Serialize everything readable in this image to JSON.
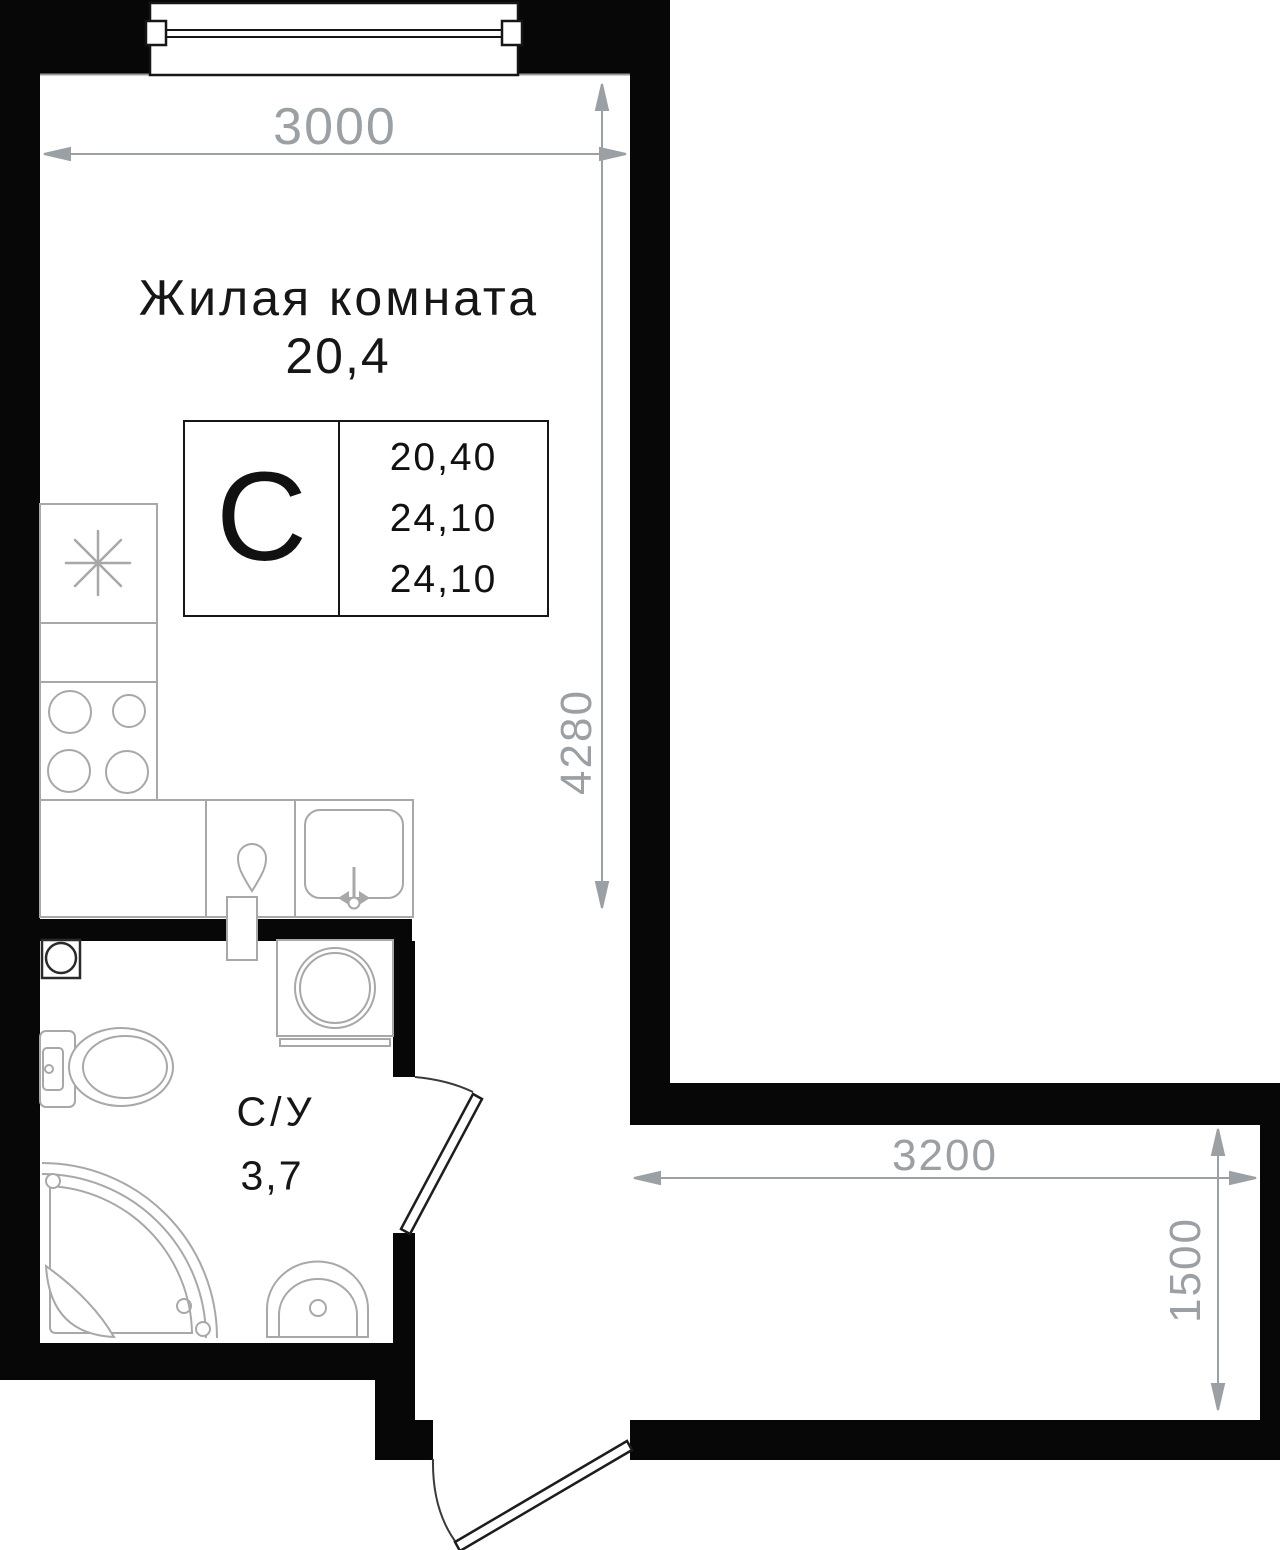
{
  "plan_title": "Studio apartment floor plan",
  "living_room": {
    "label": "Жилая комната",
    "area": "20,4"
  },
  "bathroom": {
    "label": "С/У",
    "area": "3,7"
  },
  "unit_card": {
    "type_letter": "С",
    "values": [
      "20,40",
      "24,10",
      "24,10"
    ]
  },
  "dimensions": {
    "top_width": "3000",
    "living_height": "4280",
    "hall_width": "3200",
    "hall_height": "1500"
  },
  "colors": {
    "wall": "#070707",
    "fixture_line": "#a8a8a8",
    "dimension": "#9aa0a4",
    "label_text": "#161616"
  }
}
